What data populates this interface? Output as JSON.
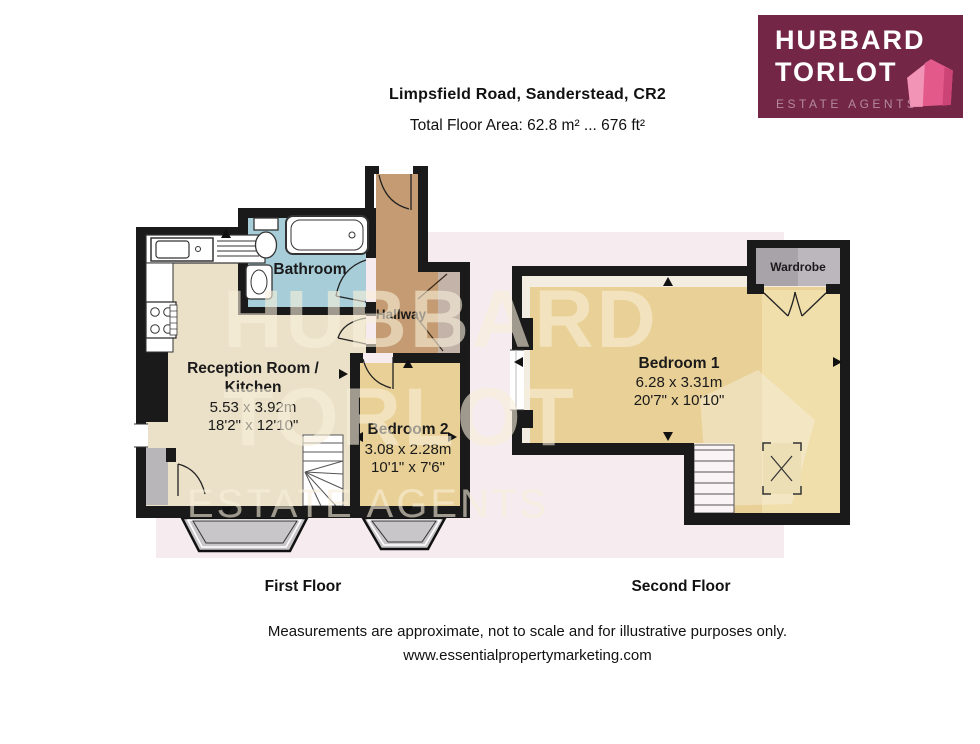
{
  "header": {
    "title": "Limpsfield Road, Sanderstead, CR2",
    "subtitle": "Total Floor Area: 62.8 m² ... 676 ft²"
  },
  "logo": {
    "name_line1": "HUBBARD",
    "name_line2": "TORLOT",
    "tagline": "ESTATE AGENTS",
    "bg_color": "#732645",
    "house_pink": "#e2598a",
    "tagline_color": "#b48aa0"
  },
  "watermark": {
    "line1": "HUBBARD",
    "line2": "TORLOT",
    "line3": "ESTATE AGENTS",
    "band_color": "#f6ebee",
    "letter_color": "#f8f0da"
  },
  "floors": {
    "first": {
      "label": "First Floor",
      "rooms": {
        "bathroom": {
          "name": "Bathroom"
        },
        "hallway": {
          "name": "Hallway"
        },
        "reception": {
          "name_line1": "Reception Room /",
          "name_line2": "Kitchen",
          "dims_metric": "5.53 x 3.92m",
          "dims_imperial": "18'2\" x 12'10\""
        },
        "bedroom2": {
          "name": "Bedroom 2",
          "dims_metric": "3.08 x 2.28m",
          "dims_imperial": "10'1\" x 7'6\""
        }
      }
    },
    "second": {
      "label": "Second Floor",
      "rooms": {
        "bedroom1": {
          "name": "Bedroom 1",
          "dims_metric": "6.28 x 3.31m",
          "dims_imperial": "20'7\" x 10'10\""
        },
        "wardrobe": {
          "name": "Wardrobe"
        }
      }
    }
  },
  "footer": {
    "disclaimer": "Measurements are approximate, not to scale and for illustrative purposes only.",
    "website": "www.essentialpropertymarketing.com"
  },
  "colors": {
    "wall": "#1a1a1a",
    "bathroom_fill": "#a7cdd9",
    "hallway_fill": "#c49b72",
    "reception_fill": "#ebe1c9",
    "bedroom_fill": "#e9d096",
    "wardrobe_fill": "#a8a2a9",
    "bay_window_fill": "#c9c6ca",
    "porch_fill": "#b9b6ba"
  }
}
